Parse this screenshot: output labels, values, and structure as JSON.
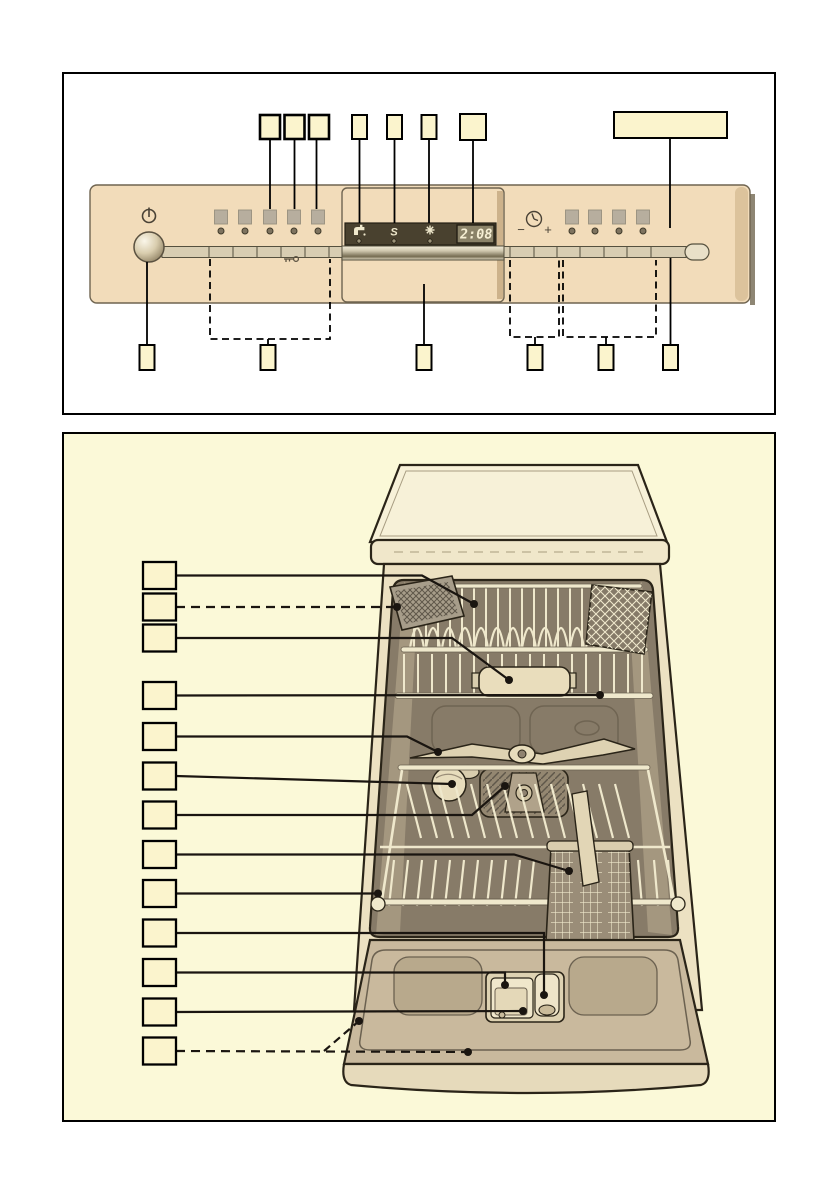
{
  "control_panel": {
    "display_time": "2:08",
    "minus_label": "−",
    "plus_label": "+",
    "salt_symbol": "S",
    "status_icons": [
      "water-supply-icon",
      "salt-refill-icon",
      "rinse-aid-icon"
    ],
    "other_icons": [
      "power-icon",
      "childproof-lock-key-icon",
      "timer-clock-icon"
    ],
    "program_button_count_left": 5,
    "option_button_count_right": 4,
    "callouts_top": [
      {
        "id": "t1",
        "label": ""
      },
      {
        "id": "t2",
        "label": ""
      },
      {
        "id": "t3",
        "label": ""
      },
      {
        "id": "t4",
        "label": ""
      },
      {
        "id": "t5",
        "label": ""
      },
      {
        "id": "t6",
        "label": ""
      },
      {
        "id": "t7",
        "label": ""
      },
      {
        "id": "t8-wide",
        "label": ""
      }
    ],
    "callouts_bottom": [
      {
        "id": "b1",
        "label": "",
        "line": "solid"
      },
      {
        "id": "b2",
        "label": "",
        "line": "dashed-bracket"
      },
      {
        "id": "b3",
        "label": "",
        "line": "solid"
      },
      {
        "id": "b4",
        "label": "",
        "line": "dashed-bracket"
      },
      {
        "id": "b5",
        "label": "",
        "line": "dashed-bracket"
      },
      {
        "id": "b6",
        "label": "",
        "line": "solid"
      }
    ]
  },
  "dishwasher": {
    "callouts": [
      {
        "id": 1,
        "label": "",
        "line": "solid"
      },
      {
        "id": 2,
        "label": "",
        "line": "dashed"
      },
      {
        "id": 3,
        "label": "",
        "line": "solid"
      },
      {
        "id": 4,
        "label": "",
        "line": "solid"
      },
      {
        "id": 5,
        "label": "",
        "line": "solid"
      },
      {
        "id": 6,
        "label": "",
        "line": "solid"
      },
      {
        "id": 7,
        "label": "",
        "line": "solid"
      },
      {
        "id": 8,
        "label": "",
        "line": "solid"
      },
      {
        "id": 9,
        "label": "",
        "line": "solid"
      },
      {
        "id": 10,
        "label": "",
        "line": "solid"
      },
      {
        "id": 11,
        "label": "",
        "line": "solid"
      },
      {
        "id": 12,
        "label": "",
        "line": "solid"
      },
      {
        "id": 13,
        "label": "",
        "line": "dashed"
      }
    ],
    "parts_depicted": [
      "top-rack",
      "upper-spray-arm",
      "vent-tray",
      "interior-duct",
      "middle-spray-arm",
      "bowl",
      "spray-head",
      "cutlery-basket",
      "lower-rack",
      "basket-handle",
      "detergent-dispenser",
      "dispenser-lid",
      "rinse-aid-cap",
      "door-panel"
    ]
  },
  "colors": {
    "figure2_bg": "#fbf9d8",
    "callout_fill": "#fbf4cd",
    "panel_tan": "#f2dcba",
    "display_strip": "#49412f",
    "display_window": "#8a8268",
    "digit_cream": "#f6efd4",
    "tub_interior": "#877b68",
    "door_tan": "#c9b99d",
    "wire_cream": "#efe8cc"
  }
}
